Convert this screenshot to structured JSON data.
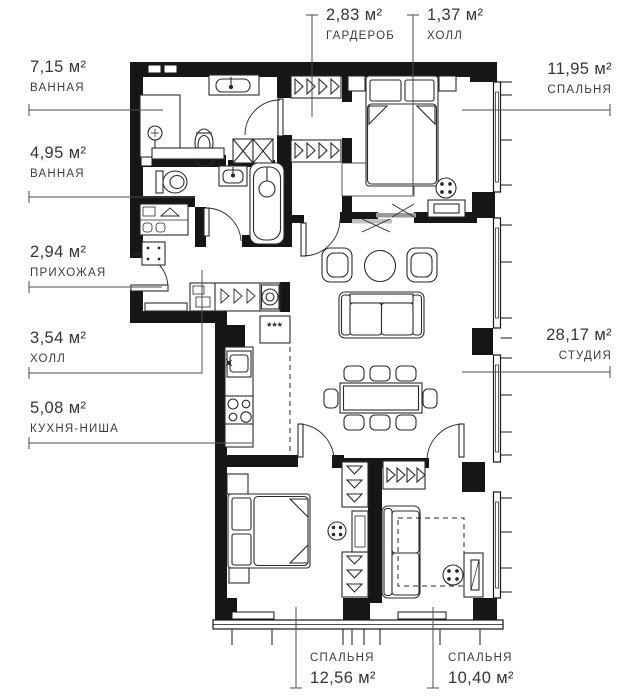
{
  "plan": {
    "type": "apartment-floor-plan",
    "units": "м²",
    "line_color": "#1a1a1a",
    "text_color": "#3c3c3c"
  },
  "labels": {
    "left": [
      {
        "value": "7,15 м²",
        "name": "ВАННАЯ"
      },
      {
        "value": "4,95 м²",
        "name": "ВАННАЯ"
      },
      {
        "value": "2,94 м²",
        "name": "ПРИХОЖАЯ"
      },
      {
        "value": "3,54 м²",
        "name": "ХОЛЛ"
      },
      {
        "value": "5,08 м²",
        "name": "КУХНЯ-НИША"
      }
    ],
    "top": [
      {
        "value": "2,83 м²",
        "name": "ГАРДЕРОБ"
      },
      {
        "value": "1,37 м²",
        "name": "ХОЛЛ"
      }
    ],
    "right": [
      {
        "value": "11,95 м²",
        "name": "СПАЛЬНЯ"
      },
      {
        "value": "28,17 м²",
        "name": "СТУДИЯ"
      }
    ],
    "bottom": [
      {
        "name": "СПАЛЬНЯ",
        "value": "12,56 м²"
      },
      {
        "name": "СПАЛЬНЯ",
        "value": "10,40 м²"
      }
    ]
  },
  "kitchen": {
    "fridge_symbol": "***"
  }
}
